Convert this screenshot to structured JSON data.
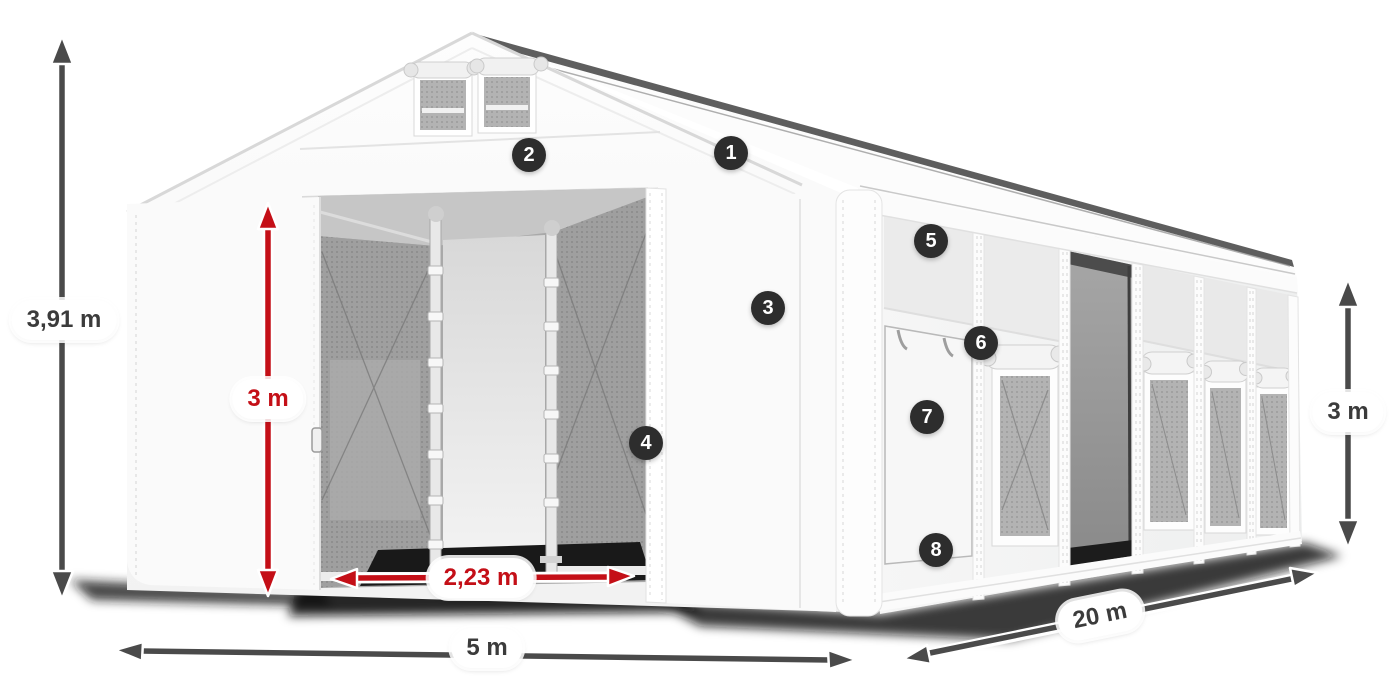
{
  "dimensions": {
    "total_height": {
      "label": "3,91 m"
    },
    "door_height": {
      "label": "3 m"
    },
    "door_width": {
      "label": "2,23 m"
    },
    "front_width": {
      "label": "5 m"
    },
    "side_length": {
      "label": "20 m"
    },
    "side_height": {
      "label": "3 m"
    }
  },
  "markers": [
    {
      "number": "1"
    },
    {
      "number": "2"
    },
    {
      "number": "3"
    },
    {
      "number": "4"
    },
    {
      "number": "5"
    },
    {
      "number": "6"
    },
    {
      "number": "7"
    },
    {
      "number": "8"
    }
  ],
  "colors": {
    "dimension_red": "#c40f17",
    "dimension_gray": "#4a4a4a",
    "marker_background": "#2d2d2d",
    "background": "#ffffff"
  }
}
